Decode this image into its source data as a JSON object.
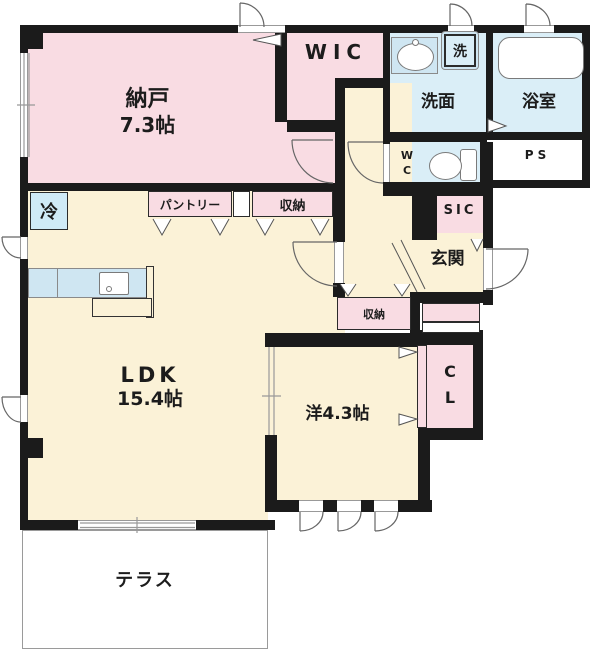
{
  "plan_title": "apartment-floor-plan",
  "rooms": {
    "nando": {
      "label": "納戸",
      "size": "7.3帖"
    },
    "wic": {
      "label": "WIC"
    },
    "senmen": {
      "label": "洗面"
    },
    "laundry": {
      "label": "洗"
    },
    "bath": {
      "label": "浴室"
    },
    "wc": {
      "l1": "W",
      "l2": "C"
    },
    "ps": {
      "label": "PS"
    },
    "sic": {
      "label": "SIC"
    },
    "genkan": {
      "label": "玄関"
    },
    "pantry": {
      "label": "パントリー"
    },
    "storage_top": {
      "label": "収納"
    },
    "fridge": {
      "label": "冷"
    },
    "ldk": {
      "label": "LDK",
      "size": "15.4帖"
    },
    "storage_hall": {
      "label": "収納"
    },
    "closet": {
      "l1": "C",
      "l2": "L"
    },
    "western": {
      "label": "洋4.3帖"
    },
    "terrace": {
      "label": "テラス"
    }
  },
  "colors": {
    "wall": "#1b1b1b",
    "room_pink": "#f9dce3",
    "room_cream": "#fbf2d7",
    "room_wet_blue": "#daeef7",
    "counter_blue": "#cfe6f2",
    "outline_gray": "#666666"
  }
}
